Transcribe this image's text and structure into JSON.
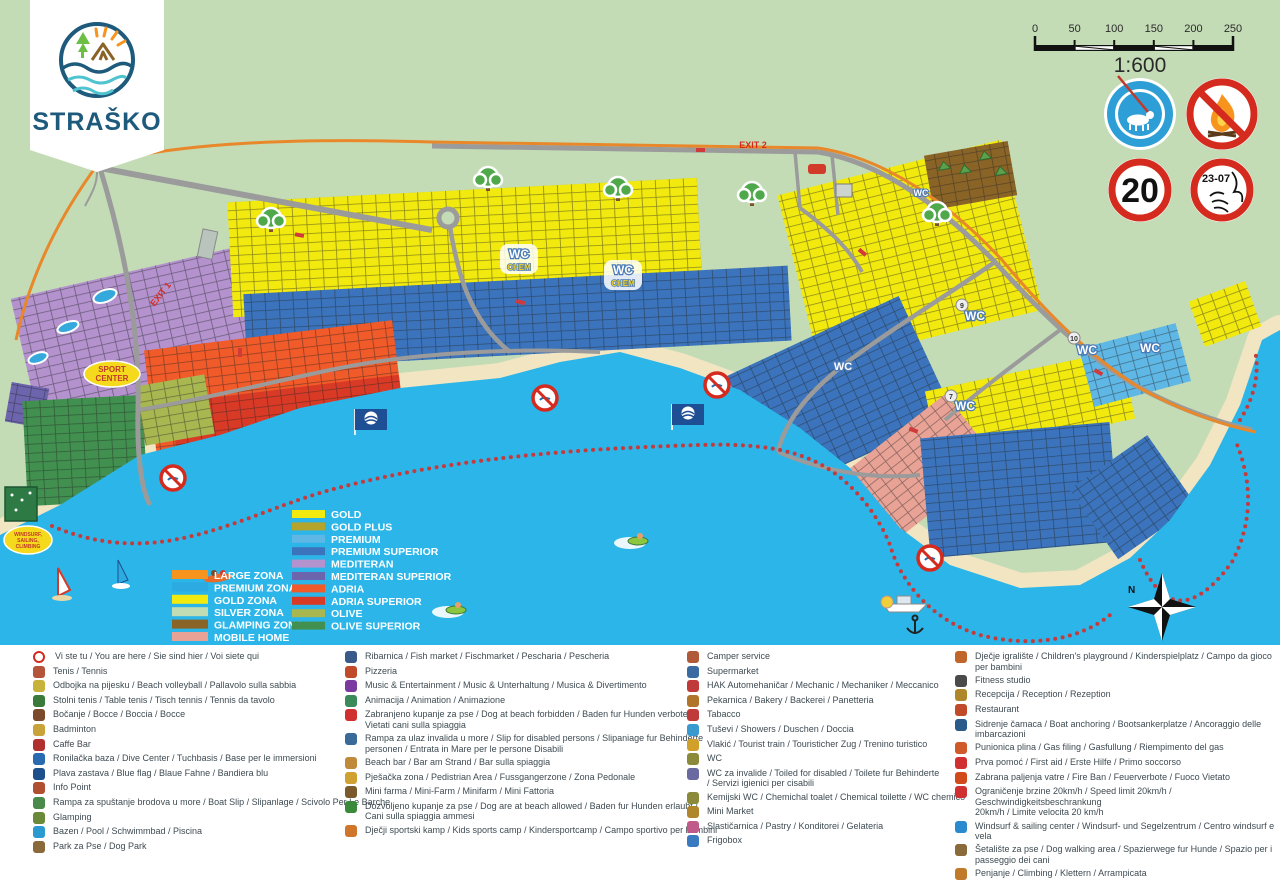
{
  "logo": {
    "name": "STRAŠKO"
  },
  "palette": {
    "land": "#c3dcb6",
    "sea": "#2cb5e8",
    "beach": "#f2e5c2",
    "road": "#9b9b9b",
    "perimeter": "#e8882a",
    "buoy": "#c53a3a",
    "sign_red": "#d42b1e",
    "sign_blue": "#2e9fd6"
  },
  "scale": {
    "labels": [
      "0",
      "50",
      "100",
      "150",
      "200",
      "250"
    ],
    "ratio": "1:600"
  },
  "signs": {
    "speed_limit": "20",
    "quiet_hours": "23-07"
  },
  "map_labels": {
    "exit1": "EXIT 1",
    "exit2": "EXIT 2",
    "sport1": "SPORT",
    "sport2": "CENTER",
    "windsurf1": "WINDSURF,",
    "windsurf2": "SAILING,",
    "windsurf3": "CLIMBING",
    "wc": "WC",
    "chem": "CHEM",
    "north": "N",
    "badge7": "7",
    "badge9": "9",
    "badge10": "10"
  },
  "zone_legend": {
    "zones": [
      {
        "label": "LARGE ZONA",
        "color": "#f7941e"
      },
      {
        "label": "PREMIUM ZONA",
        "color": "#2babe2"
      },
      {
        "label": "GOLD ZONA",
        "color": "#f2ea0f"
      },
      {
        "label": "SILVER ZONA",
        "color": "#bfdcb4"
      },
      {
        "label": "GLAMPING ZONA",
        "color": "#8a6426"
      },
      {
        "label": "MOBILE HOME",
        "color": "#e9a396"
      }
    ],
    "categories": [
      {
        "label": "GOLD",
        "color": "#f2ea0f"
      },
      {
        "label": "GOLD PLUS",
        "color": "#b5a42c"
      },
      {
        "label": "PREMIUM",
        "color": "#5fb7e5"
      },
      {
        "label": "PREMIUM SUPERIOR",
        "color": "#3b74bc"
      },
      {
        "label": "MEDITERAN",
        "color": "#b392ce"
      },
      {
        "label": "MEDITERAN SUPERIOR",
        "color": "#6d64ae"
      },
      {
        "label": "ADRIA",
        "color": "#f15a29"
      },
      {
        "label": "ADRIA SUPERIOR",
        "color": "#d93a26"
      },
      {
        "label": "OLIVE",
        "color": "#a9b751"
      },
      {
        "label": "OLIVE SUPERIOR",
        "color": "#41904f"
      }
    ]
  },
  "legend": {
    "c1": [
      {
        "i": "you-are-here-icon",
        "c": "#d42b1e",
        "t": "Vi ste tu / You are here / Sie sind hier / Voi siete qui"
      },
      {
        "i": "tennis-icon",
        "c": "#b5543a",
        "t": "Tenis / Tennis"
      },
      {
        "i": "beach-volleyball-icon",
        "c": "#c7b23a",
        "t": "Odbojka na pijesku / Beach volleyball / Pallavolo sulla sabbia"
      },
      {
        "i": "table-tennis-icon",
        "c": "#3a7a3a",
        "t": "Stolni tenis / Table tenis / Tisch tennis / Tennis da tavolo"
      },
      {
        "i": "bocce-icon",
        "c": "#7a4a2a",
        "t": "Bočanje / Bocce / Boccia / Bocce"
      },
      {
        "i": "badminton-icon",
        "c": "#caa23a",
        "t": "Badminton"
      },
      {
        "i": "caffe-bar-icon",
        "c": "#b03030",
        "t": "Caffe Bar"
      },
      {
        "i": "dive-center-icon",
        "c": "#2a6ab0",
        "t": "Ronilačka baza / Dive Center  / Tuchbasis / Base per le immersioni"
      },
      {
        "i": "blue-flag-icon",
        "c": "#1d4f8c",
        "t": "Plava zastava / Blue flag /  Blaue Fahne / Bandiera blu"
      },
      {
        "i": "info-point-icon",
        "c": "#b05030",
        "t": "Info Point"
      },
      {
        "i": "boat-slip-icon",
        "c": "#4a8a4a",
        "t": "Rampa za spuštanje brodova u more / Boat Slip / Slipanlage / Scivolo Per Le Barche"
      },
      {
        "i": "glamping-icon",
        "c": "#6a8a3a",
        "t": "Glamping"
      },
      {
        "i": "pool-icon",
        "c": "#2a9ad0",
        "t": "Bazen / Pool / Schwimmbad / Piscina"
      },
      {
        "i": "dog-park-icon",
        "c": "#8a6a3a",
        "t": "Park za Pse / Dog Park"
      }
    ],
    "c2": [
      {
        "i": "fish-market-icon",
        "c": "#3a5a8a",
        "t": "Ribarnica / Fish market / Fischmarket / Pescharia / Pescheria"
      },
      {
        "i": "pizzeria-icon",
        "c": "#c04a2a",
        "t": "Pizzeria"
      },
      {
        "i": "music-entertainment-icon",
        "c": "#7a3aa0",
        "t": "Music & Entertainment / Music & Unterhaltung / Musica & Divertimento"
      },
      {
        "i": "animation-icon",
        "c": "#3a8a5a",
        "t": "Animacija / Animation / Animazione"
      },
      {
        "i": "no-dogs-beach-icon",
        "c": "#d03030",
        "t": "Zabranjeno kupanje za pse / Dog at beach forbidden / Baden fur Hunden verboten /\nVietati cani sulla spiaggia"
      },
      {
        "i": "disabled-sea-ramp-icon",
        "c": "#3a6a9a",
        "t": "Rampa za ulaz invalida u more / Slip for disabled persons / Slipaniage fur Behinderte\npersonen / Entrata in Mare per le persone Disabili"
      },
      {
        "i": "beach-bar-icon",
        "c": "#c08a3a",
        "t": "Beach bar / Bar am Strand / Bar sulla spiaggia"
      },
      {
        "i": "pedestrian-zone-icon",
        "c": "#d0a030",
        "t": "Pješačka zona / Pedistrian Area / Fussgangerzone / Zona Pedonale"
      },
      {
        "i": "mini-farm-icon",
        "c": "#7a5a2a",
        "t": "Mini farma / Mini-Farm / Minifarm / Mini Fattoria"
      },
      {
        "i": "dogs-allowed-beach-icon",
        "c": "#3a8a3a",
        "t": "Dozvoljeno kupanje za  pse / Dog are at beach allowed / Baden fur Hunden  erlaubt /\nCani sulla spiaggia ammesi"
      },
      {
        "i": "kids-sports-camp-icon",
        "c": "#d0762a",
        "t": "Dječji sportski kamp / Kids sports camp / Kindersportcamp / Campo sportivo per bambini"
      }
    ],
    "c3": [
      {
        "i": "camper-service-icon",
        "c": "#b05a3a",
        "t": "Camper service"
      },
      {
        "i": "supermarket-icon",
        "c": "#3a6aa0",
        "t": "Supermarket"
      },
      {
        "i": "mechanic-icon",
        "c": "#c03a3a",
        "t": "HAK Automehaničar / Mechanic / Mechaniker / Meccanico"
      },
      {
        "i": "bakery-icon",
        "c": "#b0742a",
        "t": "Pekarnica / Bakery / Backerei / Panetteria"
      },
      {
        "i": "tabacco-icon",
        "c": "#c03a3a",
        "t": "Tabacco"
      },
      {
        "i": "showers-icon",
        "c": "#3a9ad0",
        "t": "Tuševi / Showers / Duschen / Doccia"
      },
      {
        "i": "tourist-train-icon",
        "c": "#d0a02a",
        "t": "Vlakić / Tourist train / Touristicher Zug / Trenino turistico"
      },
      {
        "i": "wc-icon",
        "c": "#8a8a3a",
        "t": "WC"
      },
      {
        "i": "wc-disabled-icon",
        "c": "#6a6aa0",
        "t": "WC za invalide / Toiled for disabled / Toilete fur Behinderte\n/ Servizi igienici per cisabili"
      },
      {
        "i": "chemical-wc-icon",
        "c": "#8a8a3a",
        "t": "Kemijski WC / Chemichal toalet / Chemical toilette / WC chemico"
      },
      {
        "i": "mini-market-icon",
        "c": "#b0862a",
        "t": "Mini Market"
      },
      {
        "i": "pastry-icon",
        "c": "#c05a8a",
        "t": "Slastičarnica / Pastry / Konditorei / Gelateria"
      },
      {
        "i": "frigobox-icon",
        "c": "#3a7ac0",
        "t": "Frigobox"
      }
    ],
    "c4": [
      {
        "i": "playground-icon",
        "c": "#c0662a",
        "t": "Dječje igralište / Children's playground / Kinderspielplatz / Campo da gioco per bambini"
      },
      {
        "i": "fitness-icon",
        "c": "#4a4a4a",
        "t": "Fitness studio"
      },
      {
        "i": "reception-icon",
        "c": "#b0862a",
        "t": "Recepcija / Reception / Rezeption"
      },
      {
        "i": "restaurant-icon",
        "c": "#c04a2a",
        "t": "Restaurant"
      },
      {
        "i": "boat-anchoring-icon",
        "c": "#2a5a8a",
        "t": "Sidrenje čamaca / Boat anchoring / Bootsankerplatze / Ancoraggio delle imbarcazioni"
      },
      {
        "i": "gas-filling-icon",
        "c": "#d05a2a",
        "t": "Punionica plina / Gas filing / Gasfullung / Riempimento del gas"
      },
      {
        "i": "first-aid-icon",
        "c": "#d03030",
        "t": "Prva pomoć / First aid / Erste Hilfe / Primo soccorso"
      },
      {
        "i": "fire-ban-icon",
        "c": "#d04a1a",
        "t": "Zabrana paljenja vatre / Fire Ban / Feuerverbote / Fuoco Vietato"
      },
      {
        "i": "speed-limit-icon",
        "c": "#d03030",
        "t": "Ograničenje brzine 20km/h / Speed limit 20km/h / Geschwindigkeitsbeschrankung\n20km/h / Limite velocita 20 km/h"
      },
      {
        "i": "windsurf-center-icon",
        "c": "#2a8ad0",
        "t": "Windsurf & sailing center / Windsurf- und Segelzentrum / Centro windsurf e vela"
      },
      {
        "i": "dog-walking-icon",
        "c": "#8a6a3a",
        "t": "Šetalište za pse / Dog walking area / Spazierwege fur Hunde / Spazio per i\npasseggio dei cani"
      },
      {
        "i": "climbing-icon",
        "c": "#c07a2a",
        "t": "Penjanje / Climbing / Klettern / Arrampicata"
      }
    ]
  }
}
